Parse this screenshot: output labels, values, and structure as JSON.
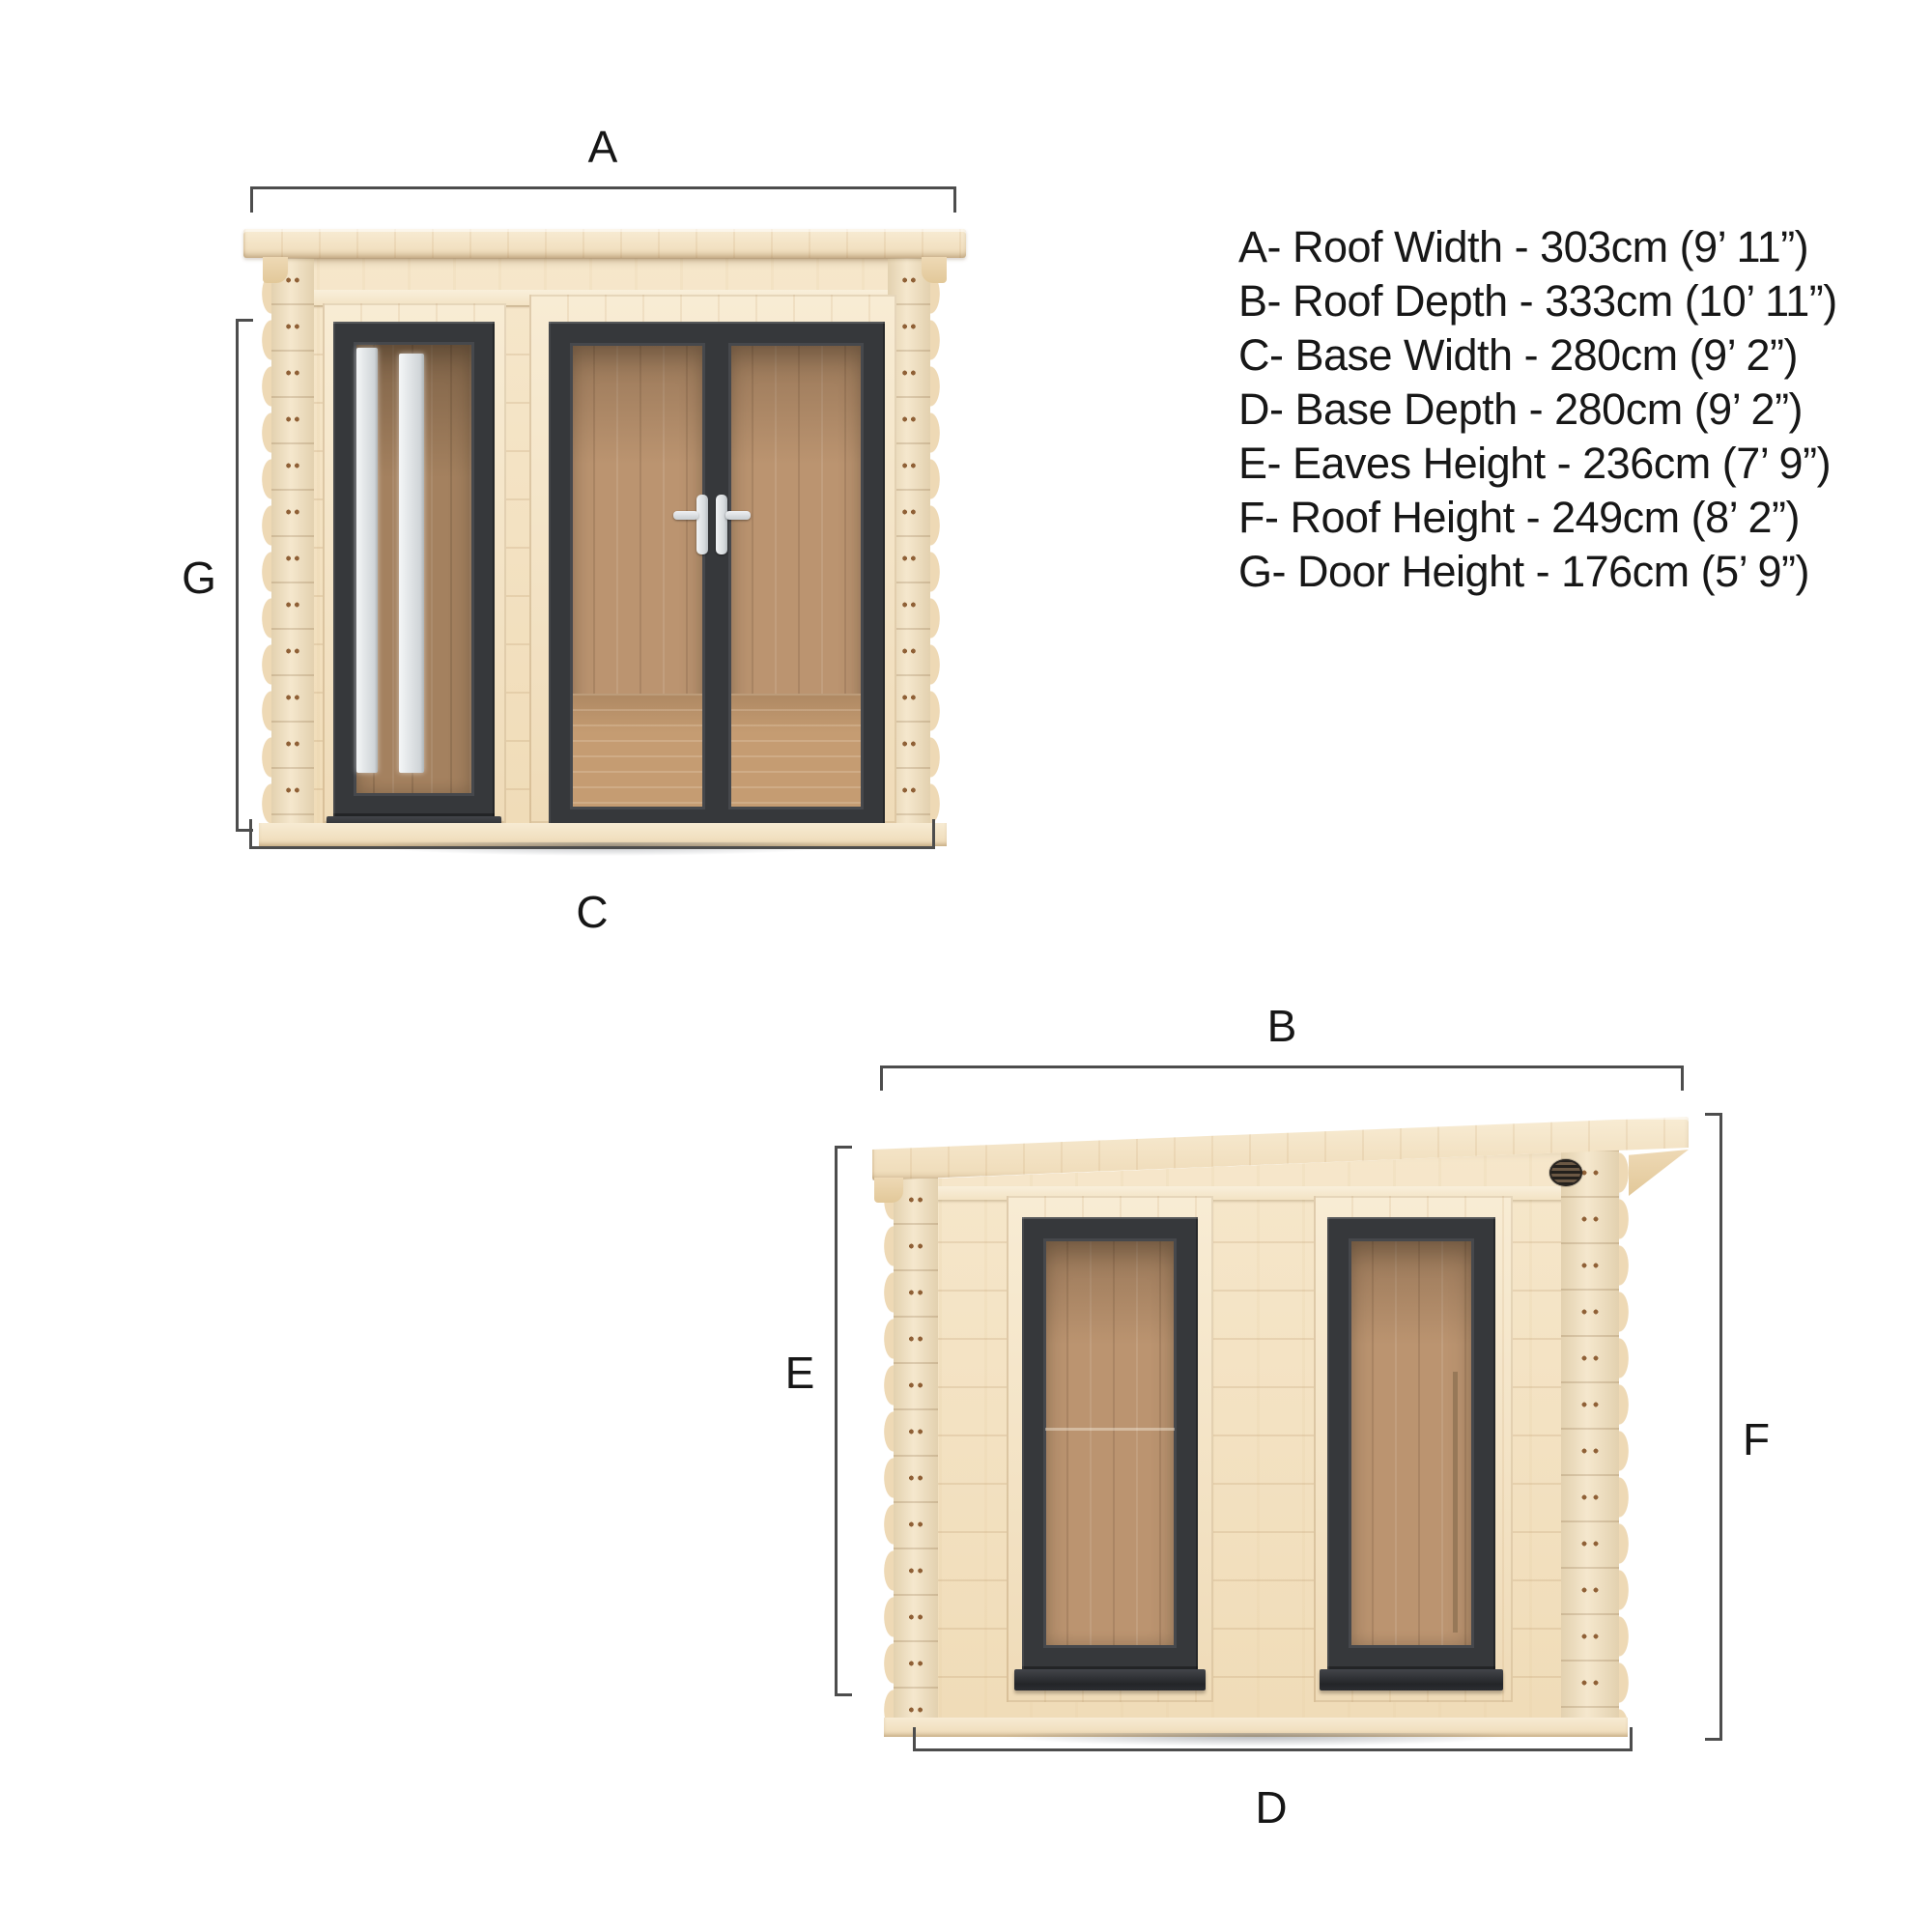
{
  "spec_list": {
    "items": [
      {
        "letter": "A",
        "label": "Roof Width",
        "metric": "303cm",
        "imperial": "9’ 11”",
        "text": "A- Roof Width - 303cm (9’ 11”)"
      },
      {
        "letter": "B",
        "label": "Roof Depth",
        "metric": "333cm",
        "imperial": "10’ 11”",
        "text": "B- Roof Depth - 333cm (10’ 11”)"
      },
      {
        "letter": "C",
        "label": "Base Width",
        "metric": "280cm",
        "imperial": "9’ 2”",
        "text": "C- Base Width - 280cm (9’ 2”)"
      },
      {
        "letter": "D",
        "label": "Base Depth",
        "metric": "280cm",
        "imperial": "9’ 2”",
        "text": "D- Base Depth - 280cm (9’ 2”)"
      },
      {
        "letter": "E",
        "label": "Eaves Height",
        "metric": "236cm",
        "imperial": "7’ 9”",
        "text": "E- Eaves Height - 236cm (7’ 9”)"
      },
      {
        "letter": "F",
        "label": "Roof Height",
        "metric": "249cm",
        "imperial": "8’ 2”",
        "text": "F- Roof Height - 249cm (8’ 2”)"
      },
      {
        "letter": "G",
        "label": "Door Height",
        "metric": "176cm",
        "imperial": "5’ 9”",
        "text": "G- Door Height - 176cm (5’ 9”)"
      }
    ]
  },
  "front_view": {
    "label_a": "A",
    "label_c": "C",
    "label_g": "G"
  },
  "side_view": {
    "label_b": "B",
    "label_d": "D",
    "label_e": "E",
    "label_f": "F"
  },
  "colors": {
    "background": "#ffffff",
    "wood_light": "#f3e2c5",
    "wood_shade": "#e7cfa6",
    "frame_dark": "#36383b",
    "interior_wood": "#bb9470",
    "handle_white": "#e9ebed",
    "dimension_line": "#4d4d4d",
    "text": "#171717"
  }
}
